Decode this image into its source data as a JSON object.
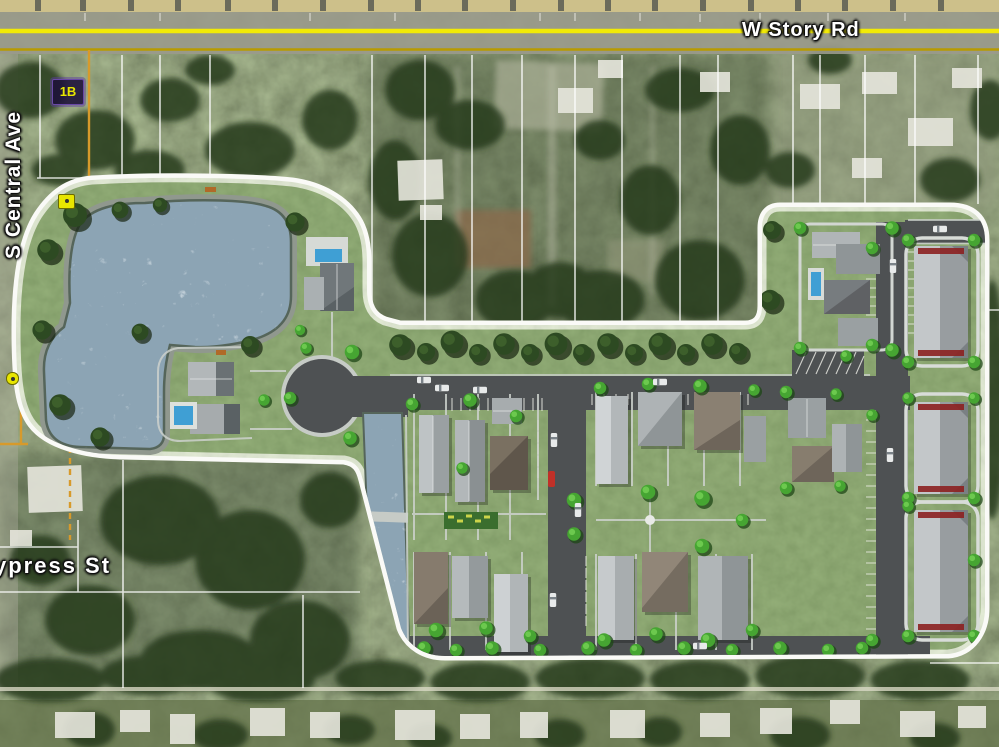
{
  "map": {
    "description": "Aerial satellite map with residential development site plan overlay",
    "streets": {
      "story_rd": "W Story Rd",
      "central_ave": "S Central Ave",
      "cypress_st": "ypress St"
    },
    "parcels": {
      "label_1b": "1B"
    },
    "colors": {
      "road_centerline_yellow": "#f2ea06",
      "road_secondary_line": "#b89b00",
      "parcel_boundary_orange": "#d79a2b",
      "parcel_line_white": "#ffffff",
      "plan_border_white": "#fafaf7",
      "plan_grass": "#74935a",
      "water": "#8ca4b4",
      "road_asphalt": "#4e5153",
      "tree_dark": "#2d4a22",
      "tree_bright": "#46a532",
      "marker_yellow": "#e8e600"
    }
  }
}
